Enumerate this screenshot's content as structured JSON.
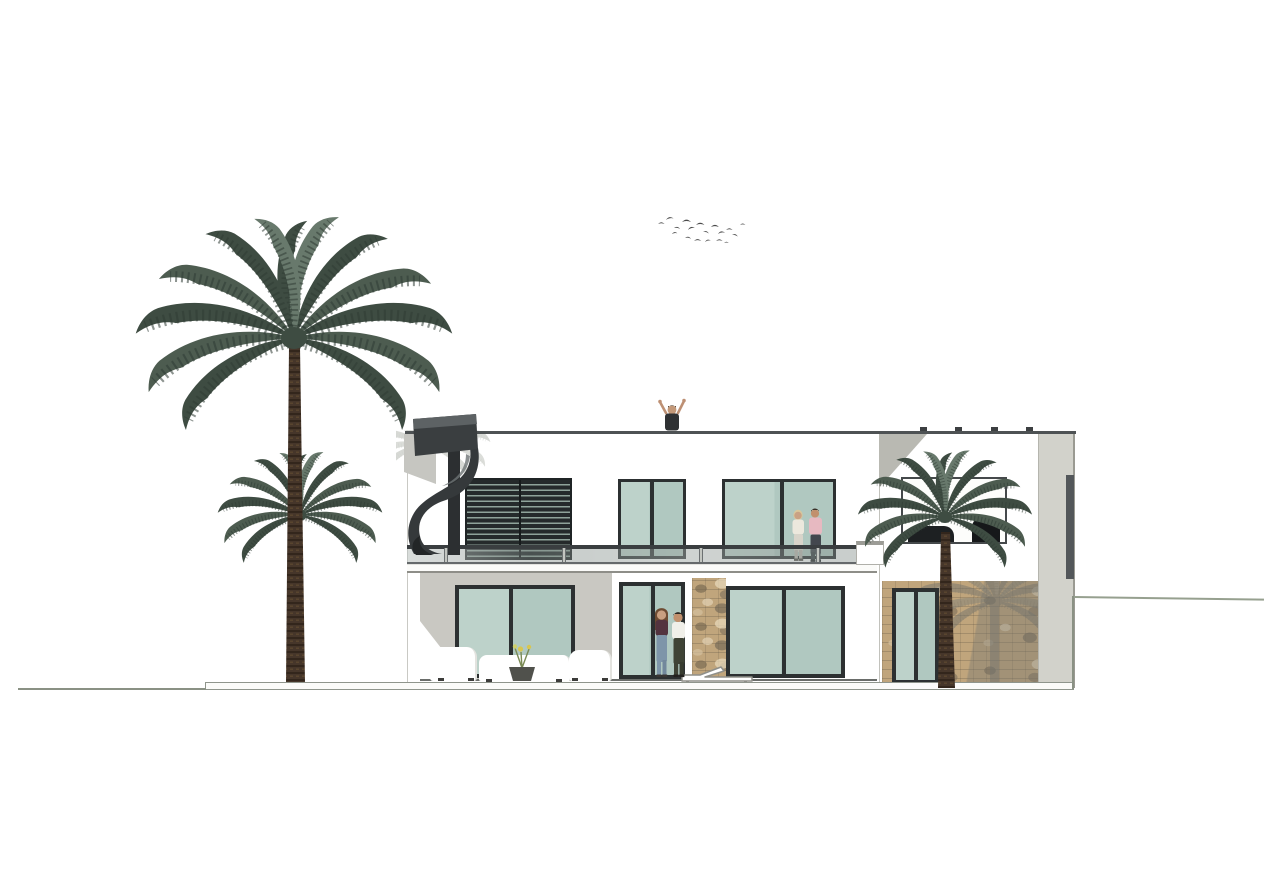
{
  "scene": {
    "kind": "architectural elevation rendering",
    "subject": "Modern two-storey flat-roof villa, rear elevation, with glass balustrade balcony, external spiral staircase, louvre screen, stone-clad wing, palm trees, birds and human figures for scale",
    "background": "#ffffff"
  },
  "colors": {
    "wall": "#ffffff",
    "wall_shadow": "#c9c8c2",
    "glass": "#b7cec6",
    "frame": "#2c3031",
    "stair": "#35393b",
    "louver_slat": "#252a2b",
    "louver_gap": "#8fa39a",
    "rail_top": "#3a3e40",
    "railing_glass": "rgba(125,137,131,0.42)",
    "stone": "#c0a57c",
    "pilaster": "#d2d2cb",
    "ground": "#8a9184",
    "slab": "#fbfbf9",
    "palm_dark": "#3e4c42",
    "palm_mid": "#4d5c50",
    "palm_light": "#68796c",
    "trunk": "#46362a",
    "bird": "#4a4a4a",
    "roofline": "#4e5254"
  },
  "elements": [
    "bird-flock",
    "tall-palm-tree",
    "small-palm-tree",
    "right-palm-tree",
    "spiral-staircase",
    "louvre-screen",
    "upper-window-left",
    "upper-window-right",
    "balcony-railing",
    "balcony-slab",
    "parapet",
    "roof-person",
    "balcony-couple",
    "ground-floor-window-left",
    "patio-door",
    "ground-couple",
    "stone-pillar",
    "ground-floor-window-right",
    "outdoor-sofa-set",
    "planter-flower",
    "sun-lounger",
    "right-wing",
    "picture-window",
    "interior-furniture-silhouette",
    "stone-wall",
    "stone-window",
    "pilaster",
    "terrace-slab",
    "ground-line-left",
    "ground-line-right"
  ]
}
